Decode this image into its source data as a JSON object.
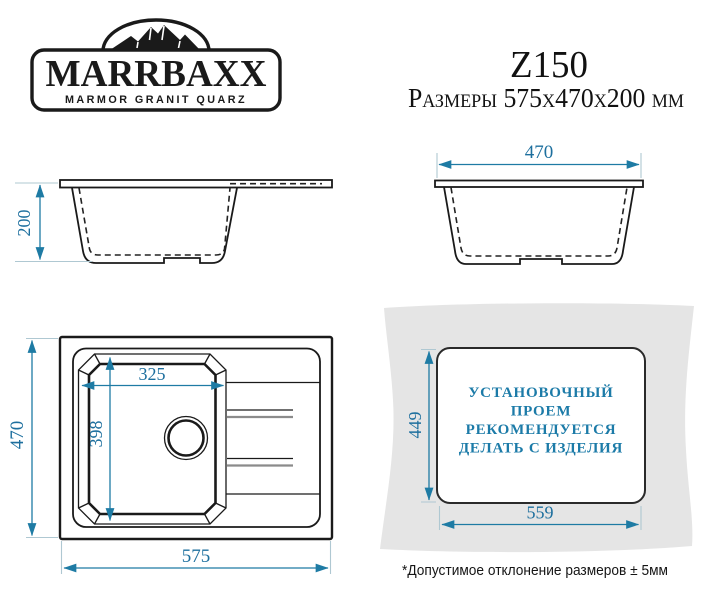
{
  "header": {
    "logo": {
      "brand": "MARRBAXX",
      "tagline": "MARMOR GRANIT QUARZ"
    },
    "model": "Z150",
    "size_line": "Размеры 575x470x200 мм"
  },
  "views": {
    "side_length": {
      "depth": "200"
    },
    "side_width": {
      "width": "470"
    },
    "top": {
      "bowl_width": "325",
      "bowl_length": "398",
      "overall_depth": "470",
      "overall_length": "575"
    },
    "cutout": {
      "height": "449",
      "width": "559",
      "note_lines": [
        "УСТАНОВОЧНЫЙ",
        "ПРОЕМ",
        "РЕКОМЕНДУЕТСЯ",
        "ДЕЛАТЬ С ИЗДЕЛИЯ"
      ]
    }
  },
  "footnote": "*Допустимое отклонение размеров ± 5мм",
  "colors": {
    "dimension_accent": "#1e7ba4",
    "note_text": "#1c7ba8",
    "counter_fill": "#e5e5e5",
    "line": "#1a1a1a"
  }
}
